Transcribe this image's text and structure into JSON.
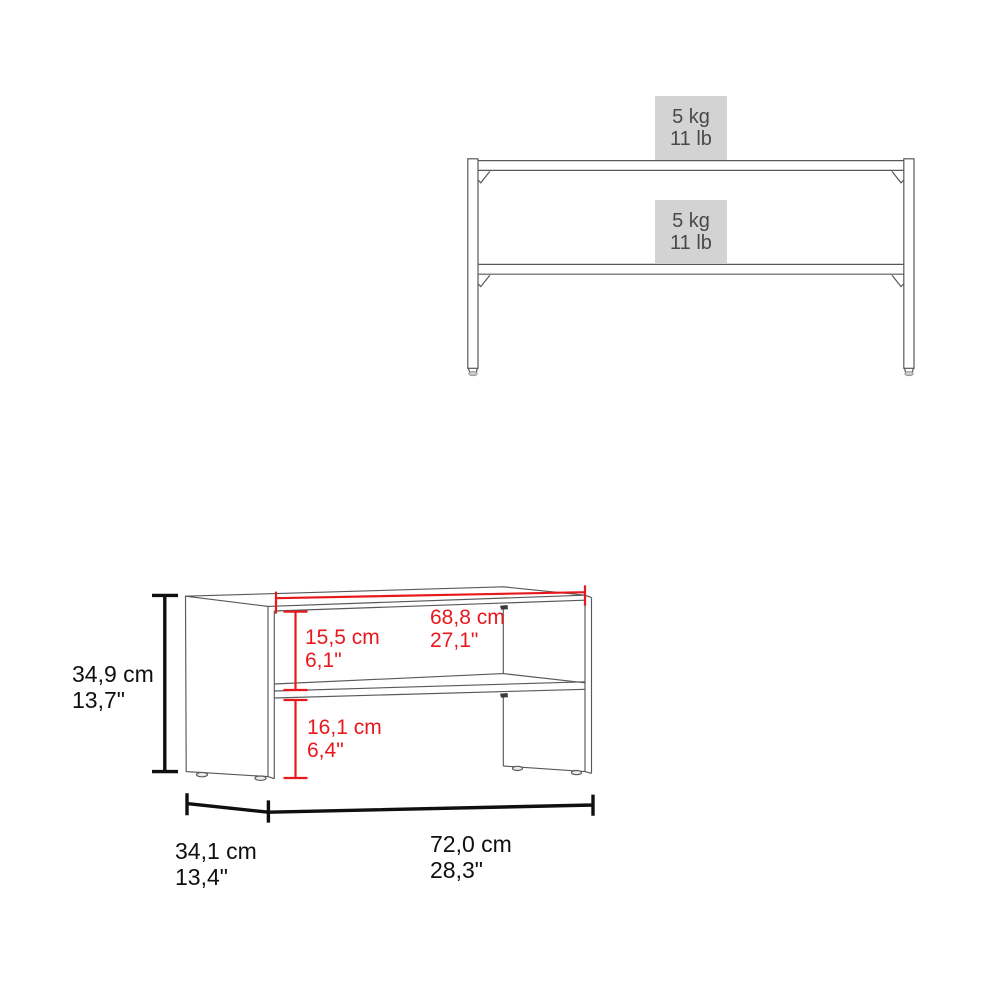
{
  "front_view": {
    "upper_badge": {
      "line1": "5 kg",
      "line2": "11 lb"
    },
    "lower_badge": {
      "line1": "5 kg",
      "line2": "11 lb"
    }
  },
  "perspective_view": {
    "height": {
      "metric": "34,9 cm",
      "imperial": "13,7\""
    },
    "inner_width": {
      "metric": "68,8 cm",
      "imperial": "27,1\""
    },
    "upper_compartment_height": {
      "metric": "15,5 cm",
      "imperial": "6,1\""
    },
    "lower_compartment_height": {
      "metric": "16,1 cm",
      "imperial": "6,4\""
    },
    "depth": {
      "metric": "34,1 cm",
      "imperial": "13,4\""
    },
    "width": {
      "metric": "72,0 cm",
      "imperial": "28,3\""
    }
  },
  "colors": {
    "dimension_red": "#e8191d",
    "dimension_black": "#0f0f0f",
    "drawing_line_gray": "#58595b",
    "capacity_badge_bg": "#d3d3d3",
    "capacity_badge_text": "#48494b"
  }
}
